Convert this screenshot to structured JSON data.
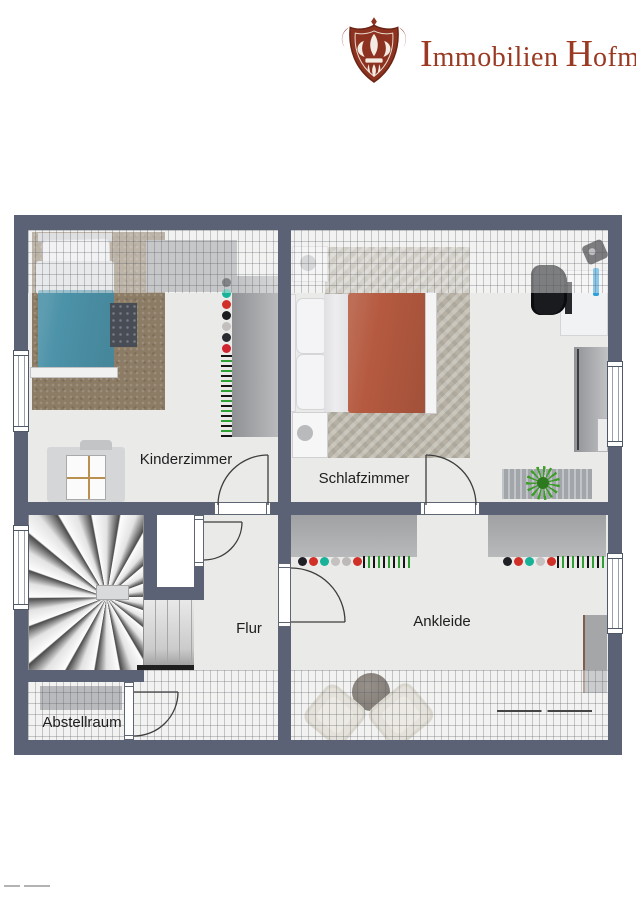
{
  "brand": {
    "name": "Immobilien Hofmann",
    "word1_initial": "I",
    "word1_rest": "mmobilien",
    "word2_initial": "H",
    "word2_rest": "ofmann",
    "logo_icon": "fleur-de-lis-crest-icon",
    "logo_color": "#9a3a23"
  },
  "floorplan": {
    "rooms": {
      "kinderzimmer": {
        "label": "Kinderzimmer"
      },
      "schlafzimmer": {
        "label": "Schlafzimmer"
      },
      "flur": {
        "label": "Flur"
      },
      "ankleide": {
        "label": "Ankleide"
      },
      "abstellraum": {
        "label": "Abstellraum"
      }
    },
    "colors": {
      "wall": "#5b6276",
      "floor": "#eaeae9",
      "child_bed_blanket": "#4c92a8",
      "child_carpet": "#8c7c65",
      "master_bed_blanket": "#b55a40",
      "plant_green": "#3a9e27"
    },
    "furniture_items": [
      "single-bed",
      "wardrobe",
      "clothes-rail",
      "kids-desk",
      "double-bed",
      "nightstand",
      "office-desk",
      "office-chair",
      "monitor",
      "sideboard",
      "plant",
      "winder-staircase",
      "straight-steps",
      "round-table",
      "armchair",
      "shelf",
      "clothes-line"
    ]
  }
}
